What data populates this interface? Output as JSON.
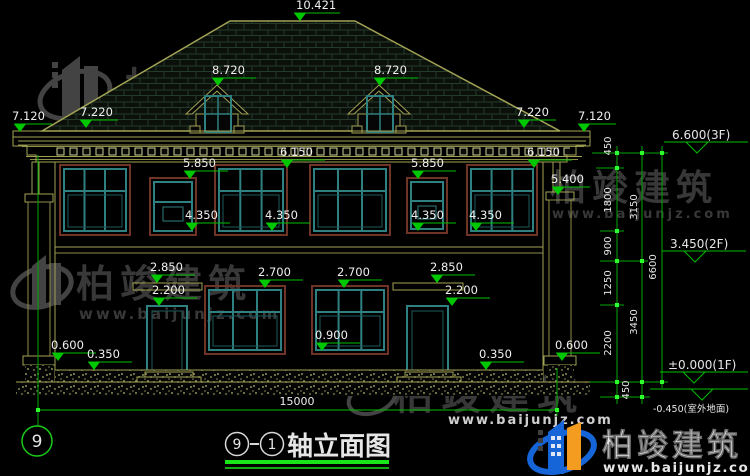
{
  "watermark": {
    "brand": "柏竣建筑",
    "url": "www.baijunjz.com"
  },
  "footer": {
    "brand": "柏竣建筑",
    "url": "www.baijunjz.com"
  },
  "title": {
    "axis_from": "9",
    "axis_to": "1",
    "text": "轴立面图"
  },
  "axis_bubble": "9",
  "overall_width": "15000",
  "levels": {
    "ridge": "10.421",
    "dormer": "8.720",
    "eave_outer": "7.120",
    "eave_inner": "7.220",
    "wall_top": "6.150",
    "win2_top": "5.850",
    "pilaster_cap": "5.400",
    "win2_sill": "4.350",
    "canopy": "2.850",
    "win1_top": "2.700",
    "door_top": "2.200",
    "win1_sill": "0.900",
    "base_cap": "0.600",
    "plinth": "0.350"
  },
  "vdims": {
    "v450": "450",
    "v1800": "1800",
    "v900": "900",
    "v1250": "1250",
    "v2200": "2200",
    "v3150": "3150",
    "v3450": "3450",
    "v6600": "6600"
  },
  "floors": {
    "f3": "6.600(3F)",
    "f2": "3.450(2F)",
    "f1": "±0.000(1F)",
    "outdoor": "-0.450(室外地面)"
  }
}
